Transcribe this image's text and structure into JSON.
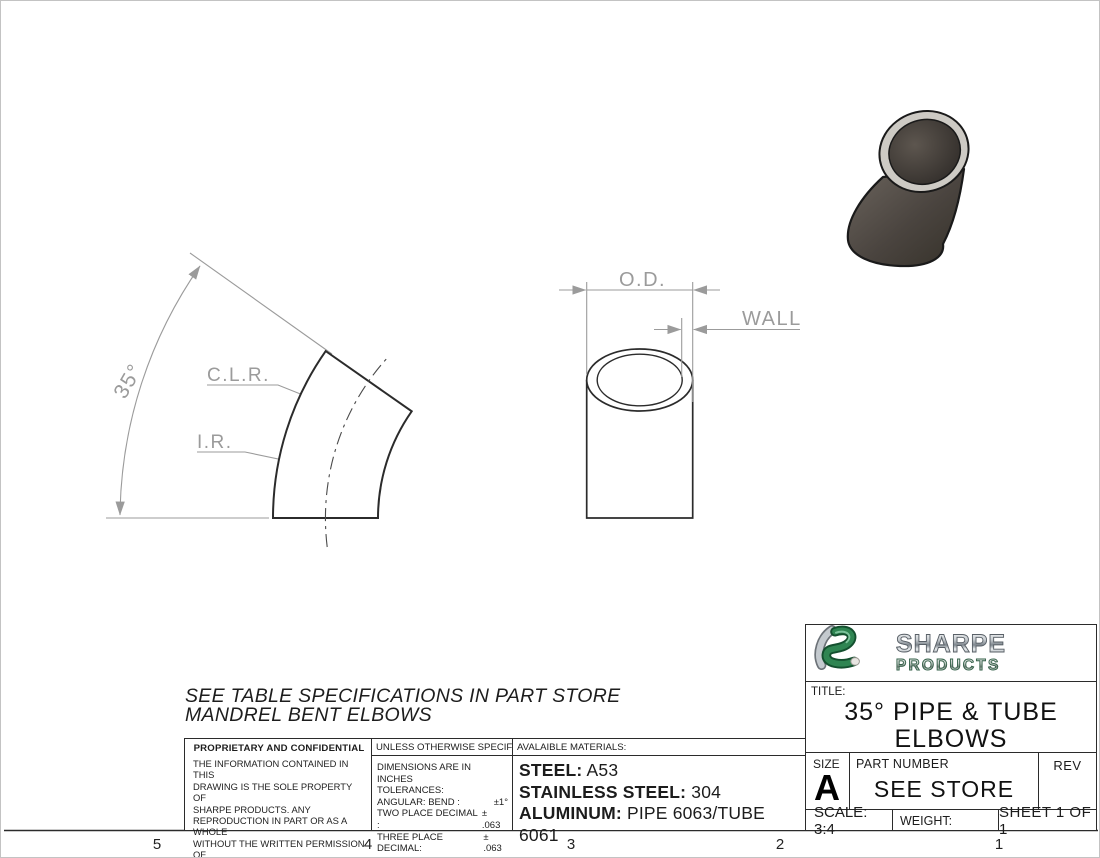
{
  "drawing": {
    "angle_view": {
      "angle": "35°",
      "clr": "C.L.R.",
      "ir": "I.R."
    },
    "section_view": {
      "od": "O.D.",
      "wall": "WALL"
    }
  },
  "note": {
    "line1": "SEE TABLE SPECIFICATIONS IN PART STORE",
    "line2": "MANDREL BENT ELBOWS"
  },
  "proprietary": {
    "header": "PROPRIETARY AND CONFIDENTIAL",
    "lines": [
      "THE INFORMATION CONTAINED IN THIS",
      "DRAWING IS THE SOLE PROPERTY OF",
      "SHARPE PRODUCTS.  ANY",
      "REPRODUCTION IN PART OR AS A WHOLE",
      "WITHOUT THE WRITTEN PERMISSION OF",
      "SHARPE PRODUCTS IS",
      "PROHIBITED."
    ]
  },
  "tolerances": {
    "header": "UNLESS OTHERWISE SPECIFIED:",
    "line1": "DIMENSIONS ARE IN INCHES",
    "line2": "TOLERANCES:",
    "rows": [
      {
        "label": "ANGULAR: BEND :",
        "value": "±1°"
      },
      {
        "label": "TWO PLACE DECIMAL  :",
        "value": "± .063"
      },
      {
        "label": "THREE PLACE DECIMAL:",
        "value": "± .063"
      }
    ]
  },
  "materials": {
    "header": "AVALAIBLE MATERIALS:",
    "items": [
      {
        "label": "STEEL:",
        "value": "A53"
      },
      {
        "label": "STAINLESS STEEL:",
        "value": "304"
      },
      {
        "label": "ALUMINUM:",
        "value": "PIPE 6063/TUBE 6061"
      }
    ]
  },
  "title_block": {
    "brand_name": "SHARPE",
    "brand_sub": "PRODUCTS",
    "title_label": "TITLE:",
    "title_line1": "35° PIPE & TUBE",
    "title_line2": "ELBOWS",
    "size_label": "SIZE",
    "size_value": "A",
    "part_label": "PART NUMBER",
    "part_value": "SEE STORE",
    "rev_label": "REV",
    "scale": "SCALE: 3:4",
    "weight_label": "WEIGHT:",
    "sheet": "SHEET 1 OF 1"
  },
  "zones": [
    "5",
    "4",
    "3",
    "2",
    "1"
  ],
  "colors": {
    "dimension_gray": "#9b9b9b",
    "outline_dark": "#2b2b2b",
    "brand_green": "#2a7d4f",
    "elbow_body_dark": "#4a443f",
    "elbow_rim_light": "#cdcac4"
  }
}
